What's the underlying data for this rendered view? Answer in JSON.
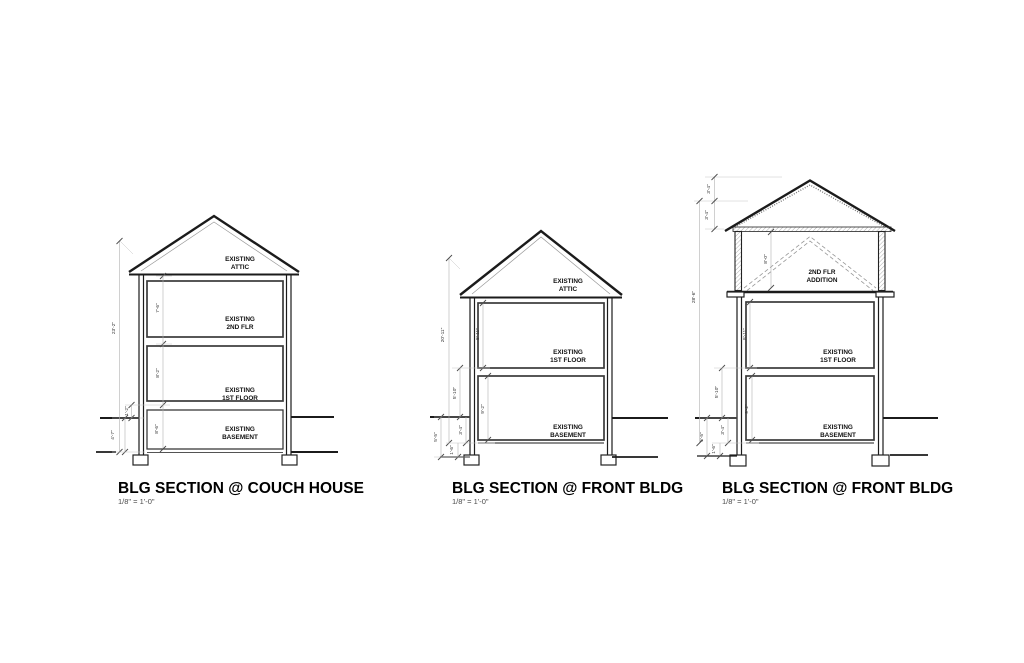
{
  "colors": {
    "background": "#ffffff",
    "line": "#1b1b1b",
    "room_line": "#3a3a3a",
    "dim_line": "#b0b0b0",
    "dim_text": "#333333",
    "label_text": "#111111",
    "dashed_existing_roof": "#979797"
  },
  "drawings": [
    {
      "title": "BLG SECTION @ COUCH HOUSE",
      "scale": "1/8\" = 1'-0\"",
      "rooms": {
        "attic": {
          "line1": "EXISTING",
          "line2": "ATTIC"
        },
        "second": {
          "line1": "EXISTING",
          "line2": "2ND FLR"
        },
        "first": {
          "line1": "EXISTING",
          "line2": "1ST FLOOR"
        },
        "basement": {
          "line1": "EXISTING",
          "line2": "BASEMENT"
        }
      },
      "dims": {
        "overall": "23'-2\"",
        "second": "7'-6\"",
        "first": "8'-2\"",
        "basement": "8'-6\"",
        "first_to_grade": "1'-2\"",
        "below_grade": "4'-7\""
      }
    },
    {
      "title": "BLG SECTION @ FRONT BLDG",
      "scale": "1/8\" = 1'-0\"",
      "rooms": {
        "attic": {
          "line1": "EXISTING",
          "line2": "ATTIC"
        },
        "first": {
          "line1": "EXISTING",
          "line2": "1ST FLOOR"
        },
        "basement": {
          "line1": "EXISTING",
          "line2": "BASEMENT"
        }
      },
      "dims": {
        "overall": "20'-11\"",
        "first": "8'-11\"",
        "basement": "9'-2\"",
        "first_to_grade": "5'-10\"",
        "grade_to_slab": "3'-4\"",
        "slab_to_footing": "1'-6\"",
        "below_grade": "5'-5\""
      }
    },
    {
      "title": "BLG SECTION @ FRONT BLDG",
      "scale": "1/8\" = 1'-0\"",
      "rooms": {
        "addition": {
          "line1": "2ND FLR",
          "line2": "ADDITION"
        },
        "first": {
          "line1": "EXISTING",
          "line2": "1ST FLOOR"
        },
        "basement": {
          "line1": "EXISTING",
          "line2": "BASEMENT"
        }
      },
      "dims": {
        "overall": "28'-6\"",
        "ridge_upper": "3'-4\"",
        "ridge_lower": "3'-4\"",
        "addition": "8'-0\"",
        "first": "8'-11\"",
        "basement": "9'-2\"",
        "first_to_grade": "5'-10\"",
        "grade_to_slab": "3'-4\"",
        "slab_to_footing": "1'-6\"",
        "below_grade": "5'-5\""
      }
    }
  ]
}
